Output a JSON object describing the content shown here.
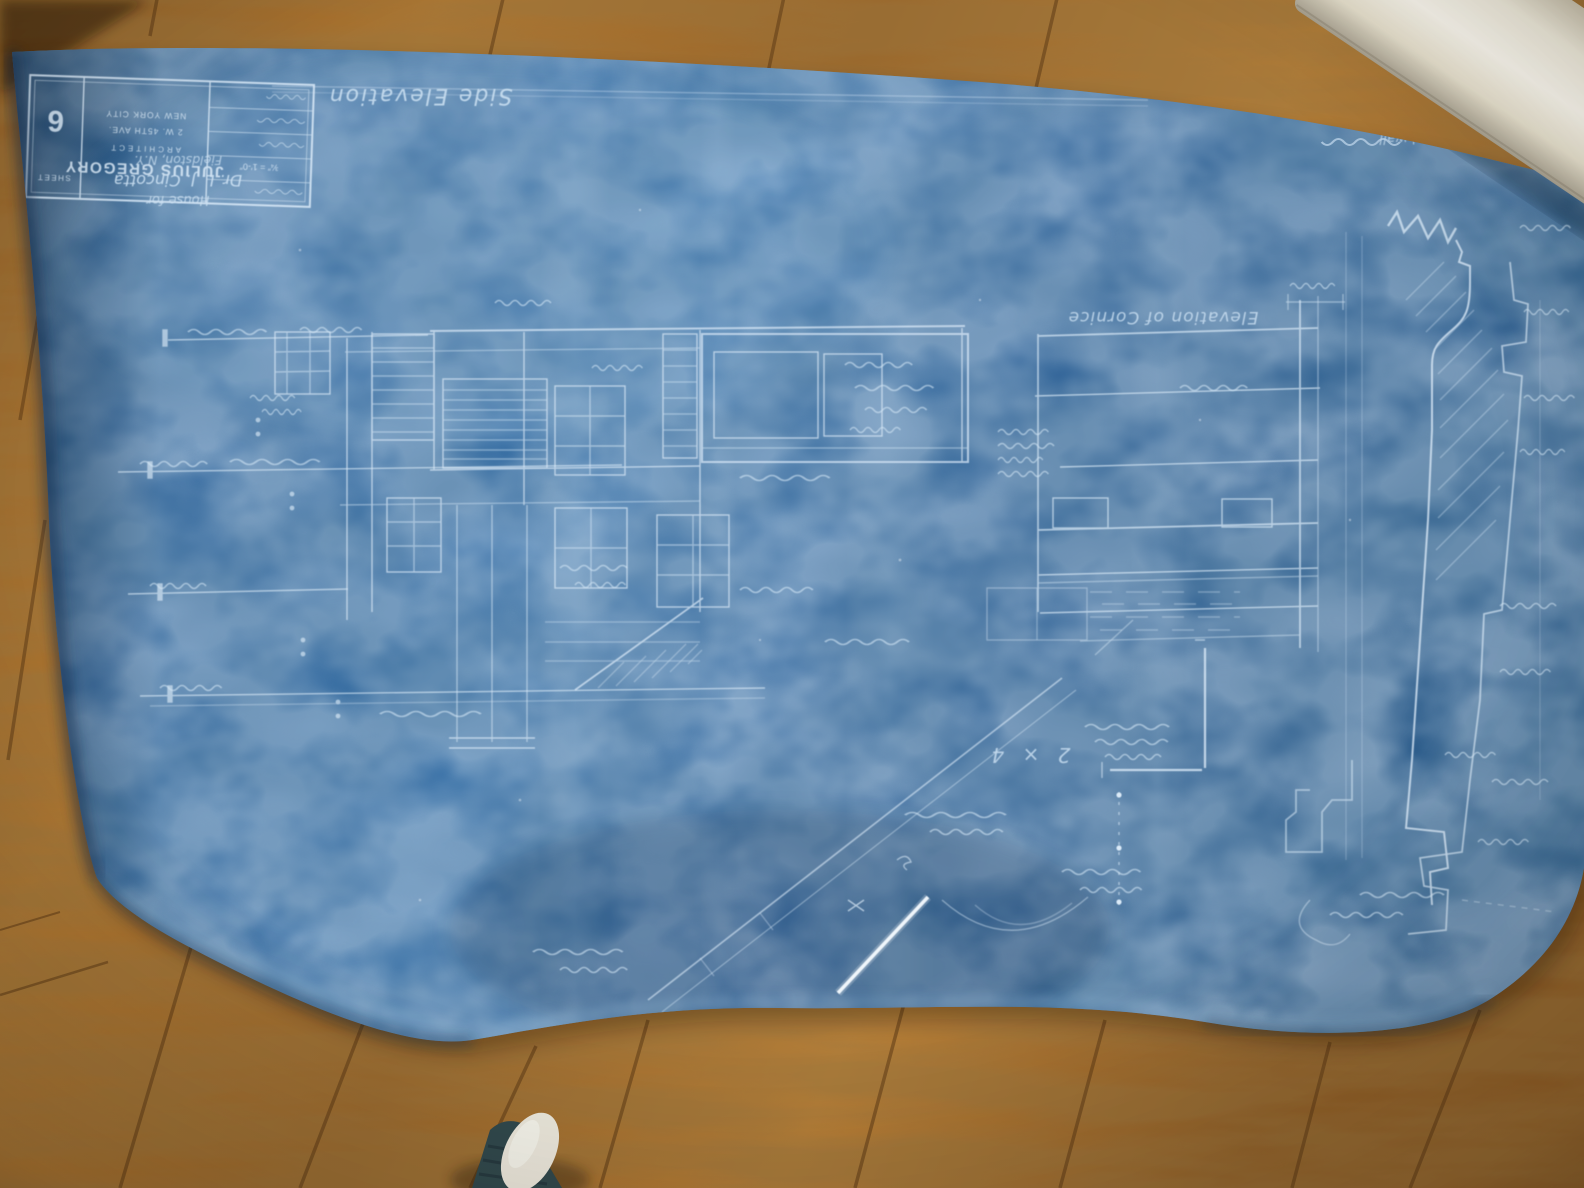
{
  "blueprint": {
    "titles": {
      "side_elevation": "Side Elevation",
      "cornice_elevation": "Elevation of Cornice",
      "section_note_1": "Section thro' wall",
      "section_note_2": "& cornice"
    },
    "title_block": {
      "name": "JULIUS GREGORY",
      "title": "ARCHITECT",
      "address": "2 W. 45TH AVE.",
      "city": "NEW YORK CITY",
      "sheet_label": "SHEET",
      "sheet_number": "6",
      "scale_note": "¾″ = 1′-0″"
    },
    "project": {
      "line1": "House for",
      "line2": "Dr. L. J. Cincotta",
      "line3": "Fieldston, N.Y."
    },
    "annotations": {
      "lumber_note": "2 × 4"
    },
    "colors": {
      "paper": "#2e69a5",
      "paper_dark": "#1f4e80",
      "line": "#dcebf8",
      "wood": "#a96f2b",
      "wood_dark": "#6e431a",
      "roll": "#f2eddd"
    }
  }
}
